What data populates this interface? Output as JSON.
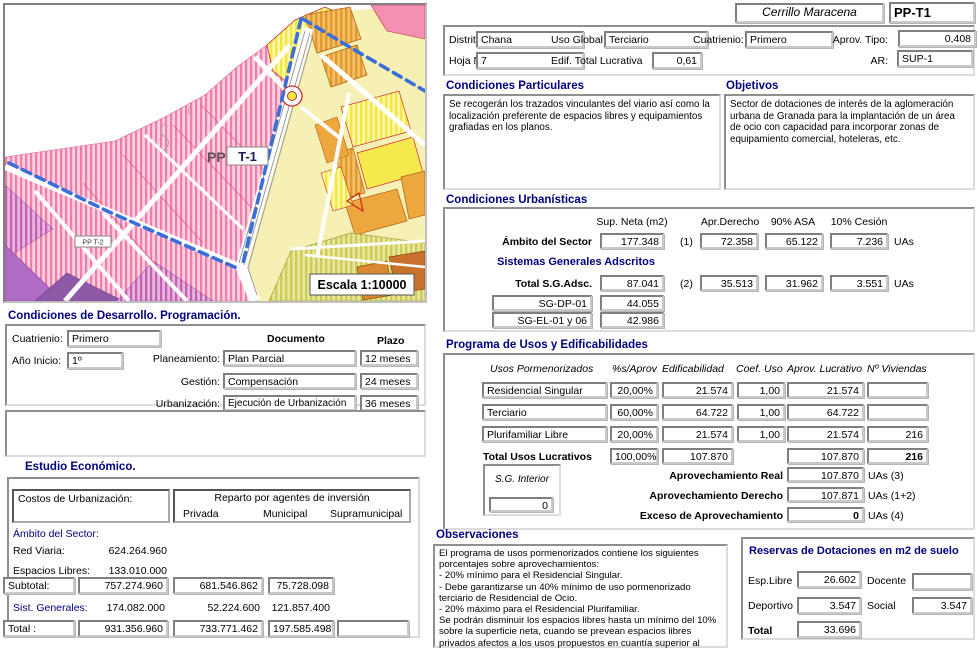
{
  "titlebar": {
    "sector_name": "Cerrillo Maracena",
    "code": "PP-T1"
  },
  "header": {
    "distrito_label": "Distrito",
    "distrito": "Chana",
    "uso_global_label": "Uso Global",
    "uso_global": "Terciario",
    "cuatrienio_label": "Cuatrienio:",
    "cuatrienio": "Primero",
    "aprov_tipo_label": "Aprov. Tipo:",
    "aprov_tipo": "0,408",
    "hoja_label": "Hoja Nº",
    "hoja": "7",
    "edif_label": "Edif. Total Lucrativa",
    "edif": "0,61",
    "ar_label": "AR:",
    "ar": "SUP-1"
  },
  "map": {
    "pp": "PP",
    "t1": "T-1",
    "pp_t2": "PP T-2",
    "escala": "Escala  1:10000"
  },
  "condiciones_particulares": {
    "title": "Condiciones Particulares",
    "text": "Se recogerán los trazados vinculantes del viario así como la localización preferente de espacios libres y equipamientos grafiadas en los planos."
  },
  "objetivos": {
    "title": "Objetivos",
    "text": "Sector de dotaciones de interés de la aglomeración urbana de Granada para la implantación de un área de ocio con capacidad para incorporar zonas de equipamiento comercial, hoteleras, etc."
  },
  "urbanisticas": {
    "title": "Condiciones Urbanísticas",
    "col_sup": "Sup. Neta (m2)",
    "col_apr": "Apr.Derecho",
    "col_asa": "90% ASA",
    "col_cesion": "10% Cesión",
    "ambito_label": "Ámbito del Sector",
    "ambito_sup": "177.348",
    "ref1": "(1)",
    "ambito_apr": "72.358",
    "ambito_asa": "65.122",
    "ambito_cesion": "7.236",
    "uas1": "UAs",
    "sg_title": "Sistemas Generales  Adscritos",
    "total_label": "Total S.G.Adsc.",
    "total_sup": "87.041",
    "ref2": "(2)",
    "total_apr": "35.513",
    "total_asa": "31.962",
    "total_cesion": "3.551",
    "uas2": "UAs",
    "sg_rows": [
      {
        "name": "SG-DP-01",
        "value": "44.055"
      },
      {
        "name": "SG-EL-01 y 06",
        "value": "42.986"
      }
    ]
  },
  "programa": {
    "title": "Programa de Usos y Edificabilidades",
    "headers": {
      "usos": "Usos Pormenorizados",
      "pct": "%s/Aprov",
      "edif": "Edificabilidad",
      "coef": "Coef. Uso",
      "aprov": "Aprov. Lucrativo",
      "viv": "Nº Viviendas"
    },
    "rows": [
      {
        "uso": "Residencial Singular",
        "pct": "20,00%",
        "edif": "21.574",
        "coef": "1,00",
        "aprov": "21.574",
        "viv": ""
      },
      {
        "uso": "Terciario",
        "pct": "60,00%",
        "edif": "64.722",
        "coef": "1,00",
        "aprov": "64.722",
        "viv": ""
      },
      {
        "uso": "Plurifamiliar Libre",
        "pct": "20,00%",
        "edif": "21.574",
        "coef": "1,00",
        "aprov": "21.574",
        "viv": "216"
      }
    ],
    "total_label": "Total Usos Lucrativos",
    "total_pct": "100,00%",
    "total_edif": "107.870",
    "total_aprov": "107.870",
    "total_viv": "216",
    "sg_interior_label": "S.G. Interior",
    "sg_interior": "0",
    "real_label": "Aprovechamiento Real",
    "real": "107.870",
    "real_unit": "UAs  (3)",
    "derecho_label": "Aprovechamiento  Derecho",
    "derecho": "107.871",
    "derecho_unit": "UAs  (1+2)",
    "exceso_label": "Exceso de Aprovechamiento",
    "exceso": "0",
    "exceso_unit": "UAs  (4)"
  },
  "observaciones": {
    "title": "Observaciones",
    "text": "El programa de usos pormenorizados contiene los siguientes porcentajes sobre aprovechamientos:\n- 20% mínimo para el Residencial Singular.\n- Debe garantizarse un 40% mínimo de uso pormenorizado terciario de Residencial de Ocio.\n- 20% máximo para el Residencial Plurifamiliar.\nSe podrán disminuir los espacios libres hasta un mínimo del 10% sobre la superficie neta, cuando se prevean espacios libres privados afectos a los usos propuestos en cuantía superior al doble de la disminución de la"
  },
  "reservas": {
    "title": "Reservas de Dotaciones en m2 de suelo",
    "esp_label": "Esp.Libre",
    "esp": "26.602",
    "docente_label": "Docente",
    "docente": "",
    "deportivo_label": "Deportivo",
    "deportivo": "3.547",
    "social_label": "Social",
    "social": "3.547",
    "total_label": "Total",
    "total": "33.696"
  },
  "desarrollo": {
    "title": "Condiciones de Desarrollo. Programación.",
    "cuatrienio_label": "Cuatrienio:",
    "cuatrienio": "Primero",
    "anio_label": "Año Inicio:",
    "anio": "1º",
    "doc_header": "Documento",
    "plazo_header": "Plazo",
    "rows": [
      {
        "label": "Planeamiento:",
        "doc": "Plan Parcial",
        "plazo": "12 meses"
      },
      {
        "label": "Gestión:",
        "doc": "Compensación",
        "plazo": "24 meses"
      },
      {
        "label": "Urbanización:",
        "doc": "Ejecución de Urbanización",
        "plazo": "36 meses"
      }
    ]
  },
  "estudio": {
    "title": "Estudio Económico.",
    "costos_label": "Costos de Urbanización:",
    "reparto_title": "Reparto por agentes de inversión",
    "agentes": [
      "Privada",
      "Municipal",
      "Supramunicipal"
    ],
    "ambito_label": "Ámbito del Sector:",
    "red_label": "Red Viaria:",
    "red": "624.264.960",
    "espacios_label": "Espacios Libres:",
    "espacios": "133.010.000",
    "subtotal_label": "Subtotal:",
    "subtotal": [
      "757.274.960",
      "681.546.862",
      "75.728.098"
    ],
    "sistgen_label": "Sist. Generales:",
    "sistgen": [
      "174.082.000",
      "52.224.600",
      "121.857.400"
    ],
    "total_label": "Total :",
    "total": [
      "931.356.960",
      "733.771.462",
      "197.585.498"
    ]
  },
  "colors": {
    "heading": "#000080",
    "boundary_blue": "#3a6fd8",
    "map_pink": "#f27ba8",
    "map_yellow": "#f2e73e",
    "map_orange": "#eca83e",
    "red_line": "#cc2a2a"
  }
}
